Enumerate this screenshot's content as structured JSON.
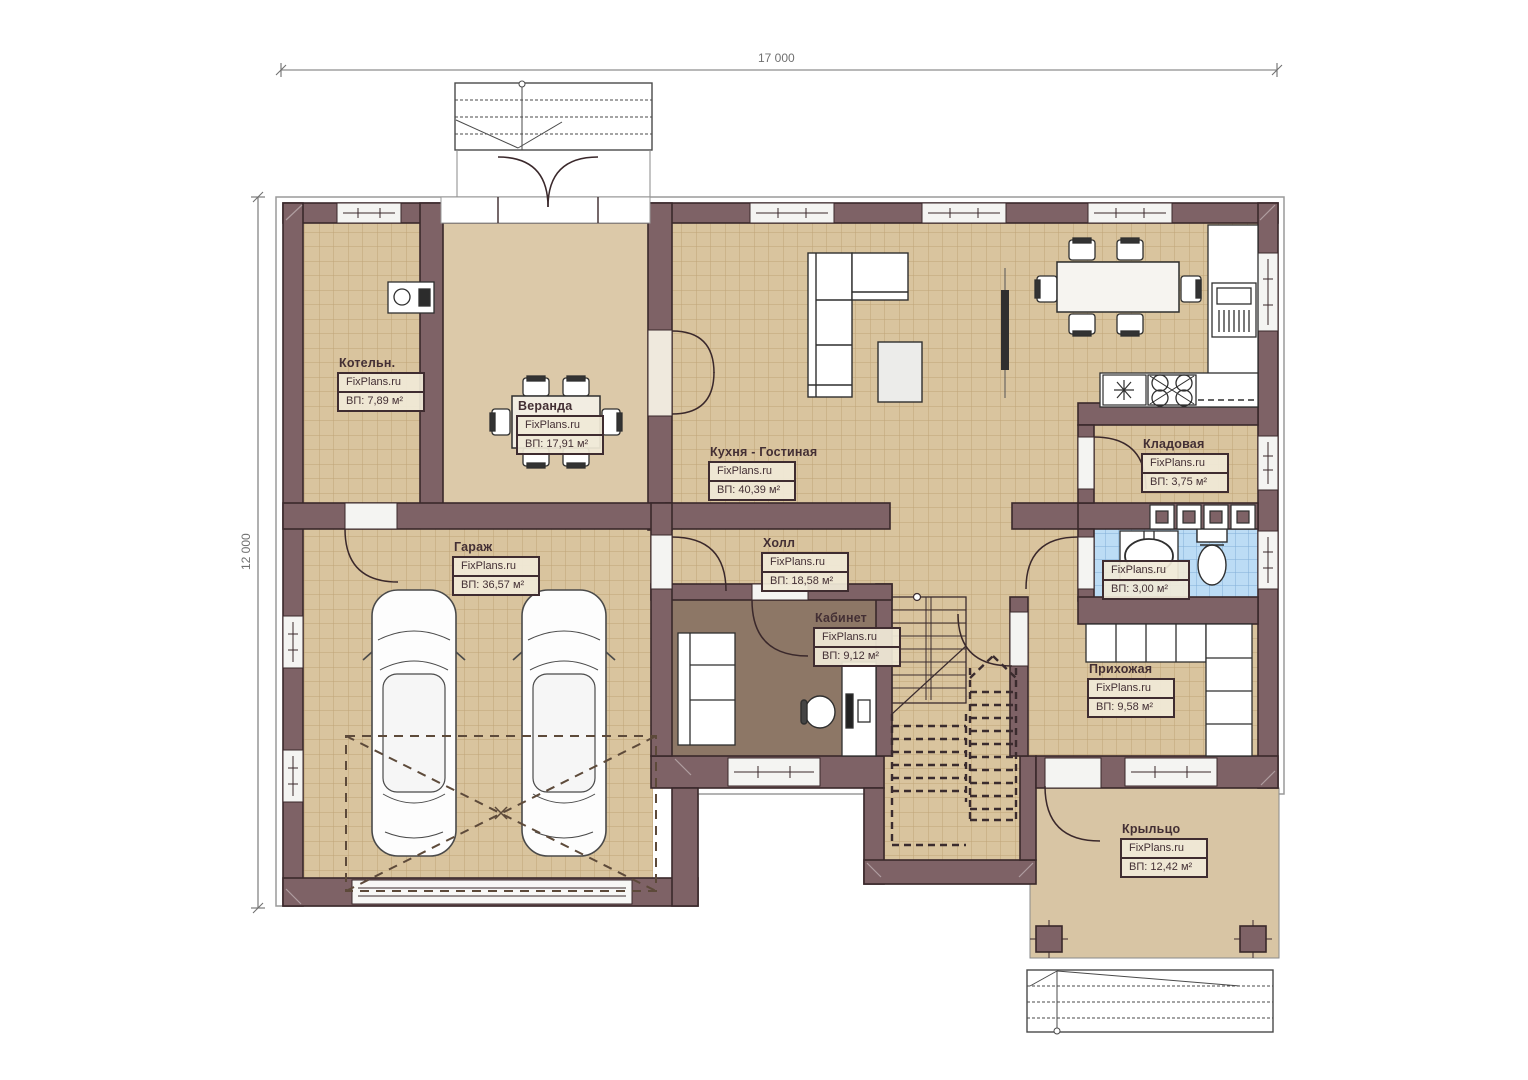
{
  "watermark": "FixPlans.ru",
  "dimensions": {
    "width": "17 000",
    "height": "12 000"
  },
  "rooms": [
    {
      "key": "kotelnaya",
      "name": "Котельн.",
      "area": "ВП: 7,89 м²"
    },
    {
      "key": "veranda",
      "name": "Веранда",
      "area": "ВП: 17,91 м²"
    },
    {
      "key": "kitchen-living",
      "name": "Кухня - Гостиная",
      "area": "ВП: 40,39 м²"
    },
    {
      "key": "pantry",
      "name": "Кладовая",
      "area": "ВП: 3,75 м²"
    },
    {
      "key": "hall",
      "name": "Холл",
      "area": "ВП: 18,58 м²"
    },
    {
      "key": "bathroom",
      "name": "",
      "area": "ВП: 3,00 м²"
    },
    {
      "key": "garage",
      "name": "Гараж",
      "area": "ВП: 36,57 м²"
    },
    {
      "key": "study",
      "name": "Кабинет",
      "area": "ВП: 9,12 м²"
    },
    {
      "key": "hallway",
      "name": "Прихожая",
      "area": "ВП: 9,58 м²"
    },
    {
      "key": "porch",
      "name": "Крыльцо",
      "area": "ВП: 12,42 м²"
    }
  ],
  "colors": {
    "wall": "#7e6266",
    "wall_outline": "#3a282b",
    "tile_floor": "#d9c49e",
    "bath_tile": "#bcdcf5",
    "veranda_floor": "#dcc9a9",
    "study_floor": "#8d7766",
    "porch_floor": "#d8c5a4"
  }
}
